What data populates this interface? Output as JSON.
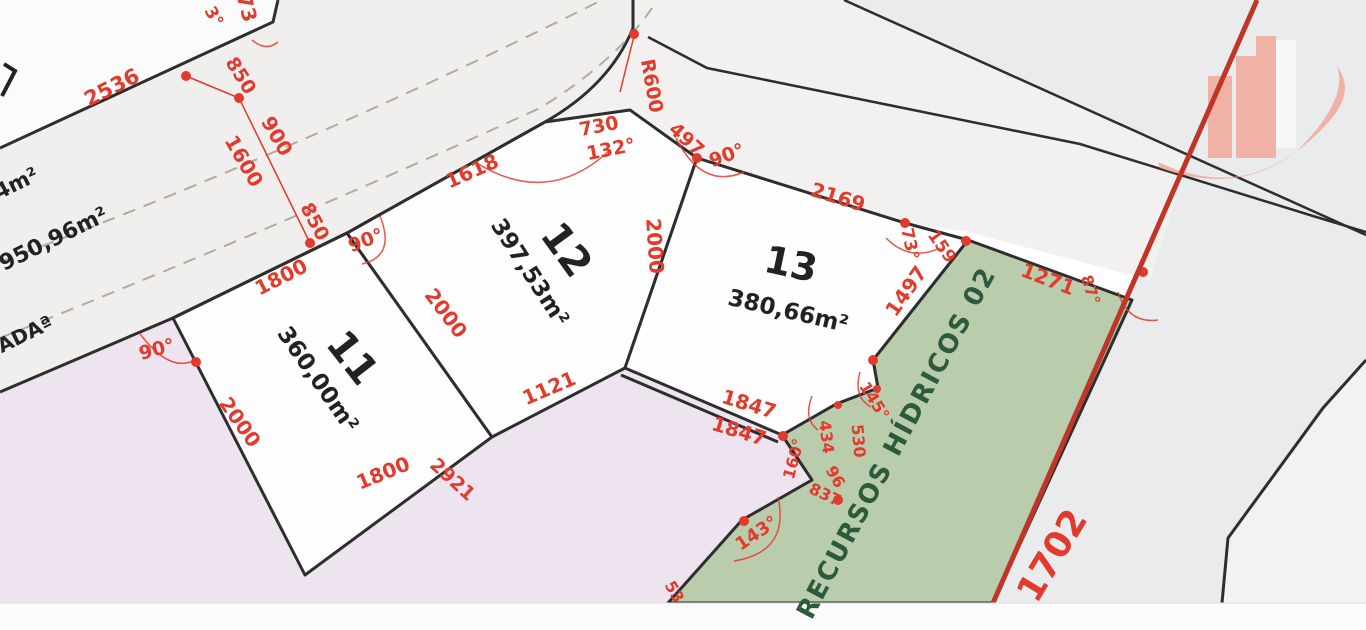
{
  "title": "Loteamento - planta de lotes 11, 12 e 13",
  "lots": [
    {
      "number": "11",
      "area": "360,00m²"
    },
    {
      "number": "12",
      "area": "397,53m²"
    },
    {
      "number": "13",
      "area": "380,66m²"
    }
  ],
  "zones": {
    "green_strip": "RECURSOS HÍDRICOS 02",
    "road_name_fragment": "ADAª",
    "neighbor_area_fragment_1": "44m²",
    "neighbor_area_fragment_2": "950,96m²",
    "boundary_measure": "1702"
  },
  "colors": {
    "red": "#e23a2c",
    "ink": "#222222",
    "green": "#2d5a3c",
    "boundary_red": "#bf3629",
    "lot_line": "#2e2e2e",
    "lot_fill": "#fefefe",
    "road_fill": "#f0efed",
    "road_b_fill": "#f2f1ef",
    "green_zone": "#b9cdad",
    "lavender_zone": "#eee4f0",
    "right_grey": "#e9ebec",
    "parcel_white": "#fbfbfb",
    "logo_salmon": "#f1a696",
    "dash": "#b3ab9d",
    "band_white": "#fcfcfc"
  },
  "logo": {
    "name": "buildings-swoosh-logo"
  },
  "labels": [
    {
      "name": "lot-11-number",
      "text": "11",
      "x": 352,
      "y": 358,
      "rot": 52,
      "size": 40,
      "w": 700,
      "color": "ink"
    },
    {
      "name": "lot-11-area",
      "text": "360,00m²",
      "x": 317,
      "y": 380,
      "rot": 55,
      "size": 23,
      "w": 600,
      "color": "ink"
    },
    {
      "name": "lot-12-number",
      "text": "12",
      "x": 566,
      "y": 250,
      "rot": 54,
      "size": 40,
      "w": 700,
      "color": "ink"
    },
    {
      "name": "lot-12-area",
      "text": "397,53m²",
      "x": 529,
      "y": 273,
      "rot": 57,
      "size": 23,
      "w": 600,
      "color": "ink"
    },
    {
      "name": "lot-13-number",
      "text": "13",
      "x": 791,
      "y": 264,
      "rot": 12,
      "size": 38,
      "w": 700,
      "color": "ink"
    },
    {
      "name": "lot-13-area",
      "text": "380,66m²",
      "x": 788,
      "y": 312,
      "rot": 13,
      "size": 23,
      "w": 600,
      "color": "ink"
    },
    {
      "name": "road-name-fragment",
      "text": "ADAª",
      "x": 25,
      "y": 334,
      "rot": -26,
      "size": 20,
      "w": 700,
      "color": "ink"
    },
    {
      "name": "neighbor-area-fragment-1",
      "text": "44m²",
      "x": 10,
      "y": 187,
      "rot": -26,
      "size": 21,
      "w": 600,
      "color": "ink"
    },
    {
      "name": "neighbor-area-fragment-2",
      "text": "950,96m²",
      "x": 54,
      "y": 240,
      "rot": -26,
      "size": 22,
      "w": 600,
      "color": "ink"
    },
    {
      "name": "green-zone-label",
      "text": "RECURSOS HÍDRICOS 02",
      "x": 897,
      "y": 443,
      "rot": -62,
      "size": 26,
      "w": 700,
      "color": "green",
      "ls": 2
    },
    {
      "name": "dim-2536",
      "text": "2536",
      "x": 112,
      "y": 88,
      "rot": -27,
      "size": 21,
      "color": "red"
    },
    {
      "name": "dim-73",
      "text": "73",
      "x": 247,
      "y": 8,
      "rot": 75,
      "size": 20,
      "color": "red"
    },
    {
      "name": "angle-3",
      "text": "3°",
      "x": 213,
      "y": 17,
      "rot": 60,
      "size": 17,
      "color": "red"
    },
    {
      "name": "dim-850-a",
      "text": "850",
      "x": 240,
      "y": 76,
      "rot": 58,
      "size": 19,
      "color": "red"
    },
    {
      "name": "dim-900",
      "text": "900",
      "x": 277,
      "y": 136,
      "rot": 60,
      "size": 20,
      "color": "red"
    },
    {
      "name": "dim-1600",
      "text": "1600",
      "x": 244,
      "y": 161,
      "rot": 60,
      "size": 20,
      "color": "red"
    },
    {
      "name": "dim-850-b",
      "text": "850",
      "x": 314,
      "y": 222,
      "rot": 62,
      "size": 19,
      "color": "red"
    },
    {
      "name": "dim-1800-road",
      "text": "1800",
      "x": 281,
      "y": 277,
      "rot": -27,
      "size": 20,
      "color": "red"
    },
    {
      "name": "angle-90-lot12",
      "text": "90°",
      "x": 366,
      "y": 241,
      "rot": -20,
      "size": 19,
      "color": "red"
    },
    {
      "name": "dim-1618",
      "text": "1618",
      "x": 472,
      "y": 171,
      "rot": -24,
      "size": 20,
      "color": "red"
    },
    {
      "name": "dim-730",
      "text": "730",
      "x": 599,
      "y": 127,
      "rot": -11,
      "size": 19,
      "color": "red"
    },
    {
      "name": "angle-132",
      "text": "132°",
      "x": 611,
      "y": 150,
      "rot": -11,
      "size": 19,
      "color": "red"
    },
    {
      "name": "dim-r600",
      "text": "R600",
      "x": 651,
      "y": 86,
      "rot": 80,
      "size": 19,
      "color": "red"
    },
    {
      "name": "dim-497",
      "text": "497",
      "x": 686,
      "y": 140,
      "rot": 42,
      "size": 19,
      "color": "red"
    },
    {
      "name": "angle-90-lot13",
      "text": "90°",
      "x": 727,
      "y": 156,
      "rot": -20,
      "size": 19,
      "color": "red"
    },
    {
      "name": "dim-2169",
      "text": "2169",
      "x": 838,
      "y": 197,
      "rot": 17,
      "size": 20,
      "color": "red"
    },
    {
      "name": "angle-73",
      "text": "73°",
      "x": 909,
      "y": 244,
      "rot": 78,
      "size": 17,
      "color": "red"
    },
    {
      "name": "dim-159",
      "text": "159",
      "x": 941,
      "y": 247,
      "rot": 55,
      "size": 17,
      "color": "red"
    },
    {
      "name": "dim-1497",
      "text": "1497",
      "x": 906,
      "y": 291,
      "rot": -55,
      "size": 20,
      "color": "red"
    },
    {
      "name": "dim-1271",
      "text": "1271",
      "x": 1048,
      "y": 279,
      "rot": 21,
      "size": 20,
      "color": "red"
    },
    {
      "name": "angle-87",
      "text": "87°",
      "x": 1090,
      "y": 290,
      "rot": 72,
      "size": 16,
      "color": "red"
    },
    {
      "name": "angle-90-lot11",
      "text": "90°",
      "x": 157,
      "y": 350,
      "rot": -15,
      "size": 19,
      "color": "red"
    },
    {
      "name": "dim-2000-left",
      "text": "2000",
      "x": 240,
      "y": 422,
      "rot": 55,
      "size": 20,
      "color": "red"
    },
    {
      "name": "dim-2000-mid",
      "text": "2000",
      "x": 446,
      "y": 313,
      "rot": 53,
      "size": 20,
      "color": "red"
    },
    {
      "name": "dim-2000-right",
      "text": "2000",
      "x": 655,
      "y": 246,
      "rot": 86,
      "size": 20,
      "color": "red"
    },
    {
      "name": "dim-1121",
      "text": "1121",
      "x": 549,
      "y": 388,
      "rot": -23,
      "size": 20,
      "color": "red"
    },
    {
      "name": "dim-1800-bottom",
      "text": "1800",
      "x": 383,
      "y": 473,
      "rot": -22,
      "size": 20,
      "color": "red"
    },
    {
      "name": "dim-2921",
      "text": "2921",
      "x": 452,
      "y": 480,
      "rot": 42,
      "size": 19,
      "color": "red"
    },
    {
      "name": "dim-1847-a",
      "text": "1847",
      "x": 749,
      "y": 404,
      "rot": 17,
      "size": 20,
      "color": "red"
    },
    {
      "name": "dim-1847-b",
      "text": "1847",
      "x": 739,
      "y": 431,
      "rot": 17,
      "size": 20,
      "color": "red"
    },
    {
      "name": "dim-434",
      "text": "434",
      "x": 826,
      "y": 437,
      "rot": 83,
      "size": 16,
      "color": "red"
    },
    {
      "name": "dim-96",
      "text": "96",
      "x": 835,
      "y": 477,
      "rot": 60,
      "size": 16,
      "color": "red"
    },
    {
      "name": "angle-160",
      "text": "160°",
      "x": 794,
      "y": 459,
      "rot": -75,
      "size": 16,
      "color": "red"
    },
    {
      "name": "dim-530",
      "text": "530",
      "x": 858,
      "y": 441,
      "rot": 85,
      "size": 16,
      "color": "red"
    },
    {
      "name": "angle-145",
      "text": "145°",
      "x": 874,
      "y": 401,
      "rot": 58,
      "size": 16,
      "color": "red"
    },
    {
      "name": "dim-837",
      "text": "837",
      "x": 825,
      "y": 495,
      "rot": 25,
      "size": 16,
      "color": "red"
    },
    {
      "name": "angle-143",
      "text": "143°",
      "x": 757,
      "y": 534,
      "rot": -34,
      "size": 18,
      "color": "red"
    },
    {
      "name": "dim-53",
      "text": "53",
      "x": 674,
      "y": 592,
      "rot": 60,
      "size": 16,
      "color": "red"
    },
    {
      "name": "dim-1702",
      "text": "1702",
      "x": 1053,
      "y": 556,
      "rot": -59,
      "size": 36,
      "w": 700,
      "color": "red"
    }
  ]
}
